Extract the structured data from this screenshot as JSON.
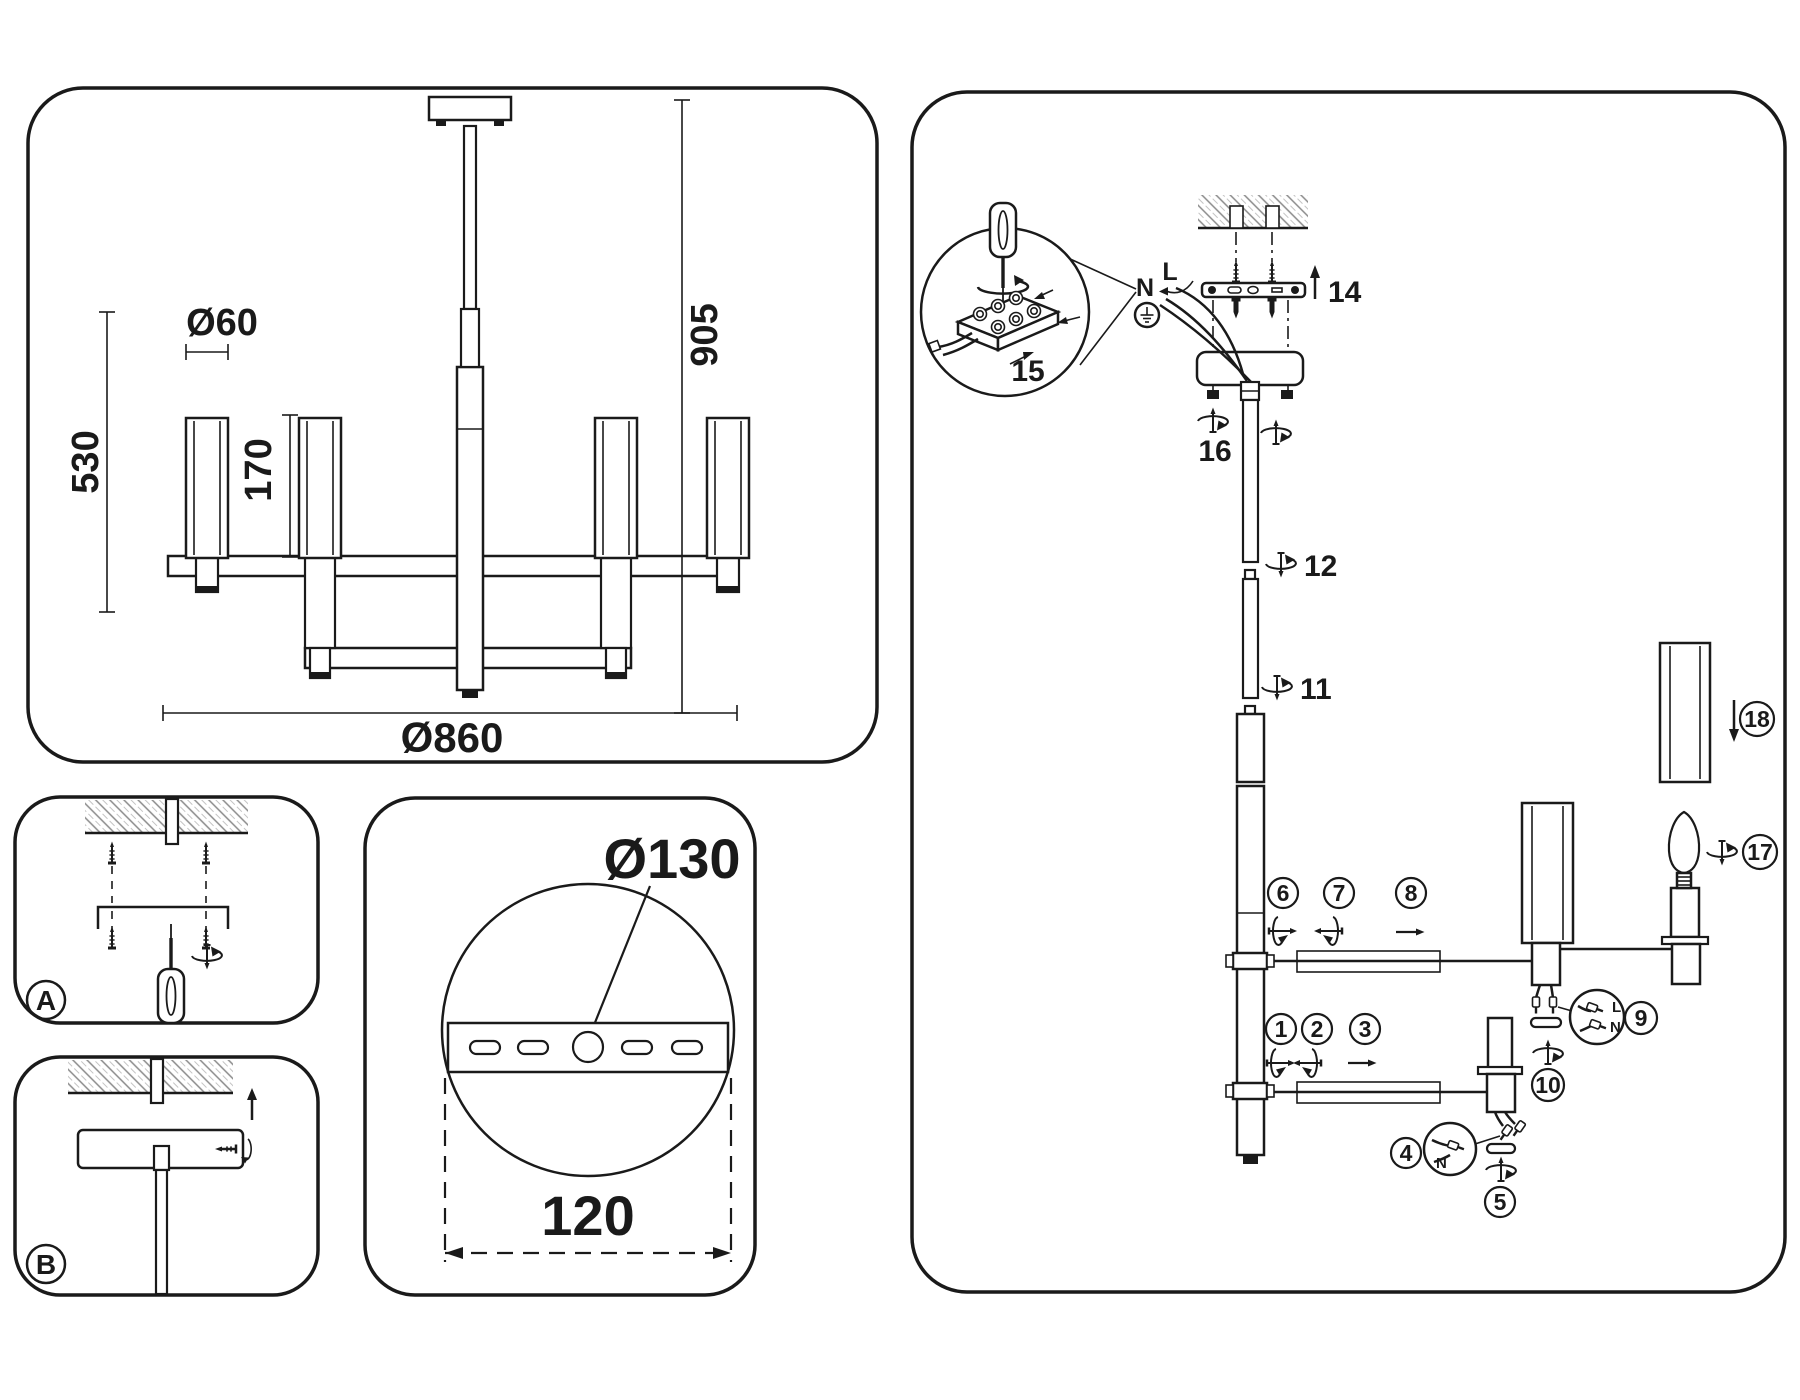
{
  "colors": {
    "line": "#1a1a1a",
    "background": "#ffffff"
  },
  "spec_panel": {
    "shade_diameter": "Ø60",
    "shade_height": "170",
    "lamp_height": "530",
    "total_height": "905",
    "total_diameter": "Ø860"
  },
  "plate_panel": {
    "plate_diameter": "Ø130",
    "mount_spacing": "120"
  },
  "step_panels": {
    "a": "A",
    "b": "B"
  },
  "assembly_panel": {
    "wire_neutral": "N",
    "wire_live": "L",
    "connector9_live": "L",
    "connector9_neutral": "N",
    "connector4_neutral": "N",
    "steps": {
      "1": "1",
      "2": "2",
      "3": "3",
      "4": "4",
      "5": "5",
      "6": "6",
      "7": "7",
      "8": "8",
      "9": "9",
      "10": "10",
      "11": "11",
      "12": "12",
      "14": "14",
      "15": "15",
      "16": "16",
      "17": "17",
      "18": "18"
    }
  }
}
